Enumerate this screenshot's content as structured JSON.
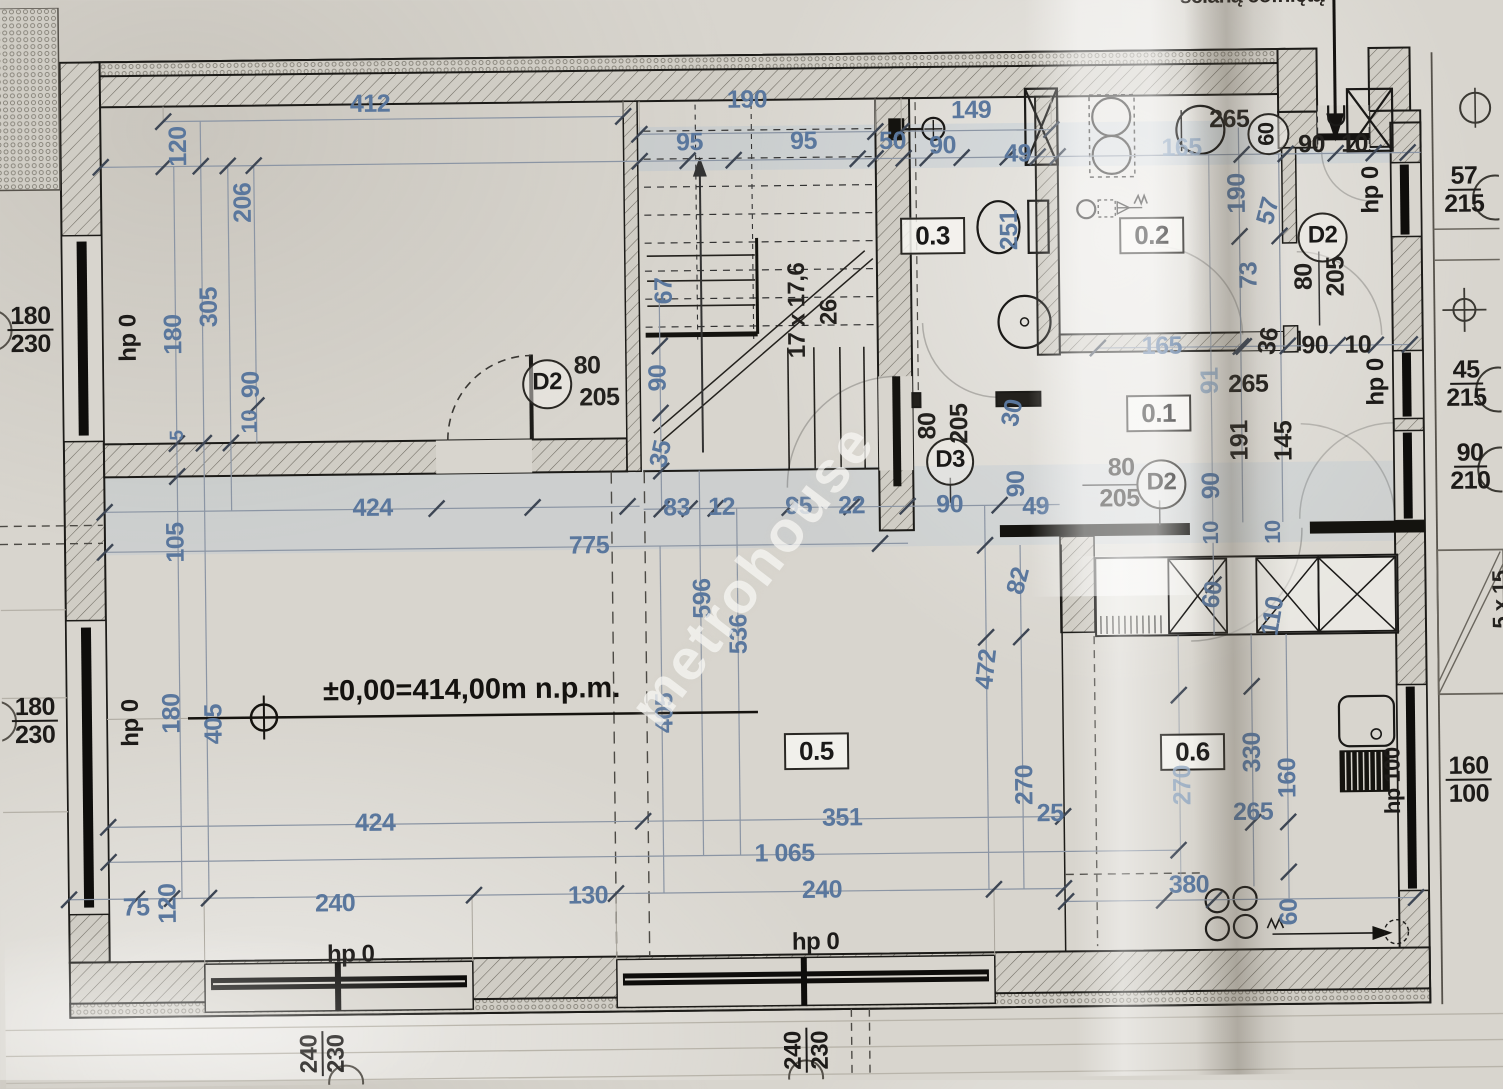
{
  "plan": {
    "watermark": "metrohouse",
    "elevation_note": "±0,00=414,00m n.p.m.",
    "stairs_note": "17 x 17,6",
    "stairs_riser": "26",
    "room_numbers": [
      "0.1",
      "0.2",
      "0.3",
      "0.4",
      "0.5",
      "0.6"
    ],
    "door_symbols": [
      "D2",
      "D3"
    ],
    "parapet_note": "hp 0",
    "accent_blue": "#5a779d",
    "ink_black": "#23211e",
    "paper": "#d8d5ce"
  },
  "labels": [
    {
      "t": "412",
      "x": 375,
      "y": 100
    },
    {
      "t": "120",
      "x": 183,
      "y": 140,
      "r": -90
    },
    {
      "t": "206",
      "x": 247,
      "y": 197,
      "r": -90
    },
    {
      "t": "305",
      "x": 212,
      "y": 301,
      "r": -90
    },
    {
      "t": "180",
      "x": 176,
      "y": 328,
      "r": -90
    },
    {
      "t": "90",
      "x": 253,
      "y": 379,
      "r": -90
    },
    {
      "t": "10",
      "x": 251,
      "y": 416,
      "r": -90,
      "s": 22
    },
    {
      "t": "5",
      "x": 179,
      "y": 429,
      "r": -90,
      "s": 19
    },
    {
      "t": "105",
      "x": 176,
      "y": 536,
      "r": -90
    },
    {
      "t": "424",
      "x": 373,
      "y": 504
    },
    {
      "t": "hp 0",
      "x": 131,
      "y": 331,
      "r": -90,
      "k": "hp"
    },
    {
      "t": "180/230",
      "x": 33,
      "y": 322,
      "k": "fr"
    },
    {
      "t": "180/230",
      "x": 33,
      "y": 713,
      "k": "fr"
    },
    {
      "t": "hp 0",
      "x": 129,
      "y": 716,
      "r": -90,
      "k": "hp"
    },
    {
      "t": "180",
      "x": 170,
      "y": 707,
      "r": -90
    },
    {
      "t": "405",
      "x": 212,
      "y": 718,
      "r": -90
    },
    {
      "t": "190",
      "x": 752,
      "y": 100
    },
    {
      "t": "95",
      "x": 694,
      "y": 142
    },
    {
      "t": "95",
      "x": 808,
      "y": 142
    },
    {
      "t": "149",
      "x": 976,
      "y": 113
    },
    {
      "t": "50",
      "x": 897,
      "y": 143
    },
    {
      "t": "90",
      "x": 947,
      "y": 148
    },
    {
      "t": "49",
      "x": 1022,
      "y": 157
    },
    {
      "t": "67",
      "x": 667,
      "y": 290,
      "r": -90
    },
    {
      "t": "17 x 17,6",
      "x": 800,
      "y": 311,
      "r": -90,
      "k": "k",
      "s": 24
    },
    {
      "t": "26",
      "x": 832,
      "y": 313,
      "r": -90,
      "k": "k",
      "s": 24
    },
    {
      "t": "0.3",
      "x": 936,
      "y": 238,
      "k": "room"
    },
    {
      "t": "251",
      "x": 1013,
      "y": 233,
      "r": -90
    },
    {
      "t": "D2",
      "x": 549,
      "y": 382,
      "k": "circ",
      "w": 46
    },
    {
      "t": "80",
      "x": 589,
      "y": 364,
      "k": "k"
    },
    {
      "t": "205",
      "x": 601,
      "y": 396,
      "k": "k"
    },
    {
      "t": "90",
      "x": 660,
      "y": 377,
      "r": -90
    },
    {
      "t": "35",
      "x": 662,
      "y": 453,
      "r": -77
    },
    {
      "t": "83",
      "x": 677,
      "y": 507
    },
    {
      "t": "12",
      "x": 722,
      "y": 507
    },
    {
      "t": "95",
      "x": 799,
      "y": 507
    },
    {
      "t": "22",
      "x": 852,
      "y": 507
    },
    {
      "t": "90",
      "x": 950,
      "y": 507
    },
    {
      "t": "775",
      "x": 589,
      "y": 544
    },
    {
      "t": "D3",
      "x": 951,
      "y": 464,
      "k": "circ",
      "w": 44
    },
    {
      "t": "80",
      "x": 929,
      "y": 428,
      "r": -90,
      "k": "k"
    },
    {
      "t": "205",
      "x": 961,
      "y": 426,
      "r": -90,
      "k": "k"
    },
    {
      "t": "165",
      "x": 1186,
      "y": 153,
      "k": "bf"
    },
    {
      "t": "265",
      "x": 1234,
      "y": 125,
      "k": "k"
    },
    {
      "t": "60",
      "x": 1273,
      "y": 140,
      "r": -90,
      "k": "circ",
      "w": 38,
      "s": 22
    },
    {
      "t": "90",
      "x": 1316,
      "y": 151,
      "k": "k"
    },
    {
      "t": "10",
      "x": 1359,
      "y": 151,
      "k": "k"
    },
    {
      "t": "190",
      "x": 1241,
      "y": 199,
      "r": -90
    },
    {
      "t": "57",
      "x": 1272,
      "y": 217,
      "r": -75
    },
    {
      "t": "73",
      "x": 1252,
      "y": 281,
      "r": -90
    },
    {
      "t": "hp 0",
      "x": 1375,
      "y": 197,
      "r": -90,
      "k": "hp"
    },
    {
      "t": "D2",
      "x": 1326,
      "y": 244,
      "k": "circ",
      "w": 46
    },
    {
      "t": "80",
      "x": 1307,
      "y": 283,
      "r": -90,
      "k": "k"
    },
    {
      "t": "205",
      "x": 1339,
      "y": 283,
      "r": -90,
      "k": "k"
    },
    {
      "t": "0.2",
      "x": 1155,
      "y": 240,
      "k": "room"
    },
    {
      "t": "165",
      "x": 1164,
      "y": 351
    },
    {
      "t": "36",
      "x": 1271,
      "y": 347,
      "r": -80,
      "k": "k"
    },
    {
      "t": "90",
      "x": 1317,
      "y": 352,
      "k": "k"
    },
    {
      "t": "10",
      "x": 1360,
      "y": 352,
      "k": "k"
    },
    {
      "t": "hp 0",
      "x": 1378,
      "y": 389,
      "r": -90,
      "k": "hp"
    },
    {
      "t": "0.1",
      "x": 1160,
      "y": 418,
      "k": "room"
    },
    {
      "t": "91",
      "x": 1212,
      "y": 386,
      "r": -90,
      "k": "bf"
    },
    {
      "t": "265",
      "x": 1250,
      "y": 390,
      "k": "k"
    },
    {
      "t": "191",
      "x": 1241,
      "y": 446,
      "r": -90,
      "k": "k"
    },
    {
      "t": "145",
      "x": 1285,
      "y": 447,
      "r": -90,
      "k": "k"
    },
    {
      "t": "90",
      "x": 1212,
      "y": 491,
      "r": -90
    },
    {
      "t": "30",
      "x": 1014,
      "y": 416,
      "r": -78
    },
    {
      "t": "90",
      "x": 1017,
      "y": 487,
      "r": -90
    },
    {
      "t": "49",
      "x": 1036,
      "y": 510
    },
    {
      "t": "80",
      "x": 1122,
      "y": 472,
      "k": "k"
    },
    {
      "t": "205",
      "x": 1120,
      "y": 503,
      "k": "k"
    },
    {
      "t": "D2",
      "x": 1162,
      "y": 489,
      "k": "circ",
      "w": 46
    },
    {
      "t": "10",
      "x": 1211,
      "y": 538,
      "r": -90,
      "s": 22
    },
    {
      "t": "10",
      "x": 1273,
      "y": 538,
      "r": -90,
      "s": 22
    },
    {
      "t": "57/215",
      "x": 1468,
      "y": 198,
      "k": "fr"
    },
    {
      "t": "45/215",
      "x": 1468,
      "y": 392,
      "k": "fr"
    },
    {
      "t": "90/210",
      "x": 1471,
      "y": 475,
      "k": "fr"
    },
    {
      "t": "596",
      "x": 702,
      "y": 598,
      "r": -90
    },
    {
      "t": "536",
      "x": 738,
      "y": 634,
      "r": -90
    },
    {
      "t": "405",
      "x": 663,
      "y": 712,
      "r": -90
    },
    {
      "t": "±0,00=414,00m n.p.m.",
      "x": 470,
      "y": 687,
      "k": "elev"
    },
    {
      "t": "0.5",
      "x": 814,
      "y": 752,
      "k": "room"
    },
    {
      "t": "472",
      "x": 985,
      "y": 672,
      "r": -83
    },
    {
      "t": "82",
      "x": 1018,
      "y": 584,
      "r": -75
    },
    {
      "t": "270",
      "x": 1022,
      "y": 788,
      "r": -90
    },
    {
      "t": "25",
      "x": 1047,
      "y": 817
    },
    {
      "t": "351",
      "x": 839,
      "y": 819
    },
    {
      "t": "1 065",
      "x": 781,
      "y": 854
    },
    {
      "t": "424",
      "x": 372,
      "y": 819
    },
    {
      "t": "240",
      "x": 331,
      "y": 899
    },
    {
      "t": "130",
      "x": 584,
      "y": 894
    },
    {
      "t": "240",
      "x": 818,
      "y": 891
    },
    {
      "t": "75",
      "x": 132,
      "y": 901
    },
    {
      "t": "120",
      "x": 164,
      "y": 897,
      "r": -90
    },
    {
      "t": "hp 0",
      "x": 346,
      "y": 950,
      "k": "hp"
    },
    {
      "t": "hp 0",
      "x": 811,
      "y": 943,
      "k": "hp"
    },
    {
      "t": "0.6",
      "x": 1190,
      "y": 757,
      "k": "room"
    },
    {
      "t": "110",
      "x": 1272,
      "y": 622,
      "r": -80
    },
    {
      "t": "60",
      "x": 1212,
      "y": 600,
      "r": -80
    },
    {
      "t": "330",
      "x": 1250,
      "y": 758,
      "r": -90
    },
    {
      "t": "160",
      "x": 1285,
      "y": 784,
      "r": -90
    },
    {
      "t": "270",
      "x": 1180,
      "y": 790,
      "r": -90,
      "k": "bf"
    },
    {
      "t": "265",
      "x": 1250,
      "y": 818
    },
    {
      "t": "380",
      "x": 1185,
      "y": 890
    },
    {
      "t": "60",
      "x": 1285,
      "y": 918,
      "r": -90
    },
    {
      "t": "hp 100",
      "x": 1390,
      "y": 788,
      "r": -90,
      "k": "hp",
      "s": 22
    },
    {
      "t": "160/100",
      "x": 1466,
      "y": 788,
      "k": "fr"
    },
    {
      "t": "5 x 15",
      "x": 1500,
      "y": 608,
      "r": -90,
      "k": "k",
      "s": 22
    },
    {
      "t": "240/230",
      "x": 317,
      "y": 1049,
      "r": -90,
      "k": "fr",
      "s": 24
    },
    {
      "t": "240/230",
      "x": 801,
      "y": 1051,
      "r": -90,
      "k": "fr",
      "s": 24
    },
    {
      "t": "ścianą cofniętą",
      "x": 1258,
      "y": 2,
      "k": "note"
    },
    {
      "t": "metrohouse",
      "x": 752,
      "y": 574,
      "r": -52,
      "k": "wm"
    }
  ]
}
